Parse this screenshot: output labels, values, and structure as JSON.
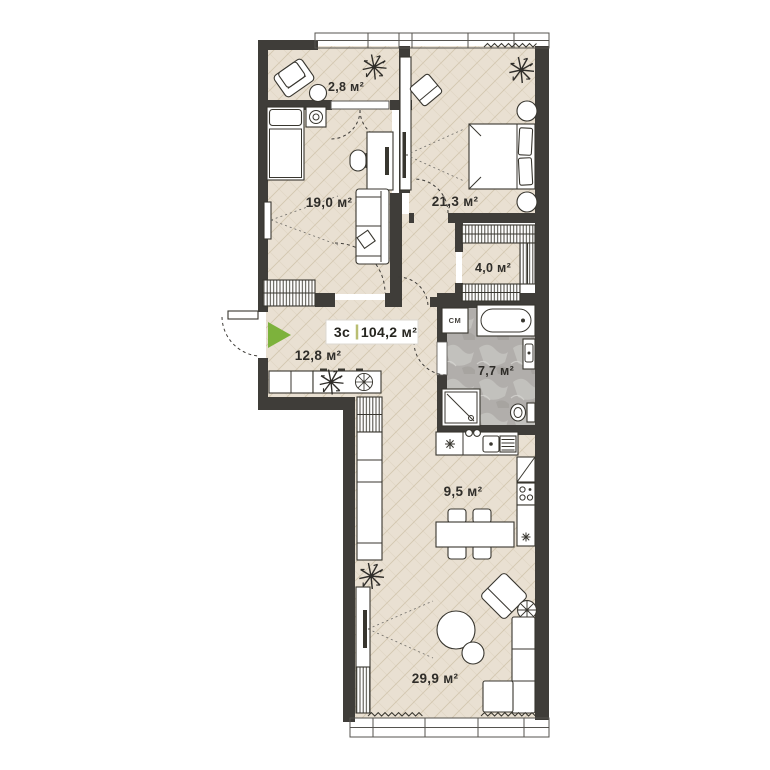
{
  "plan": {
    "badge": {
      "type_label": "3с",
      "total_area": "104,2 м²"
    },
    "rooms": [
      {
        "id": "balcony",
        "area": "2,8 м²"
      },
      {
        "id": "room-19",
        "area": "19,0 м²"
      },
      {
        "id": "bedroom",
        "area": "21,3 м²"
      },
      {
        "id": "wardrobe",
        "area": "4,0 м²"
      },
      {
        "id": "hallway",
        "area": "12,8 м²"
      },
      {
        "id": "bathroom",
        "area": "7,7 м²"
      },
      {
        "id": "kitchen",
        "area": "9,5 м²"
      },
      {
        "id": "living-room",
        "area": "29,9 м²"
      }
    ],
    "labels": {
      "washing_machine": "СМ"
    },
    "icons": [
      "entrance-arrow-icon",
      "plant-icon",
      "fan-plant-icon",
      "bed-icon",
      "double-bed-icon",
      "sofa-icon",
      "armchair-icon",
      "desk-icon",
      "chair-icon",
      "tv-icon",
      "wardrobe-icon",
      "bathtub-icon",
      "shower-icon",
      "toilet-icon",
      "sink-icon",
      "washing-machine-icon",
      "fridge-icon",
      "cooktop-icon",
      "kitchen-sink-icon",
      "dining-table-icon",
      "radiator-icon"
    ],
    "colors": {
      "wall": "#3f3d39",
      "floor": "#e9e0d2",
      "floor_line": "#d3c6b0",
      "bathroom_floor": "#b1aeab",
      "accent_green": "#7db23c",
      "badge_divider": "#b9be72",
      "text": "#2f2d29"
    }
  }
}
